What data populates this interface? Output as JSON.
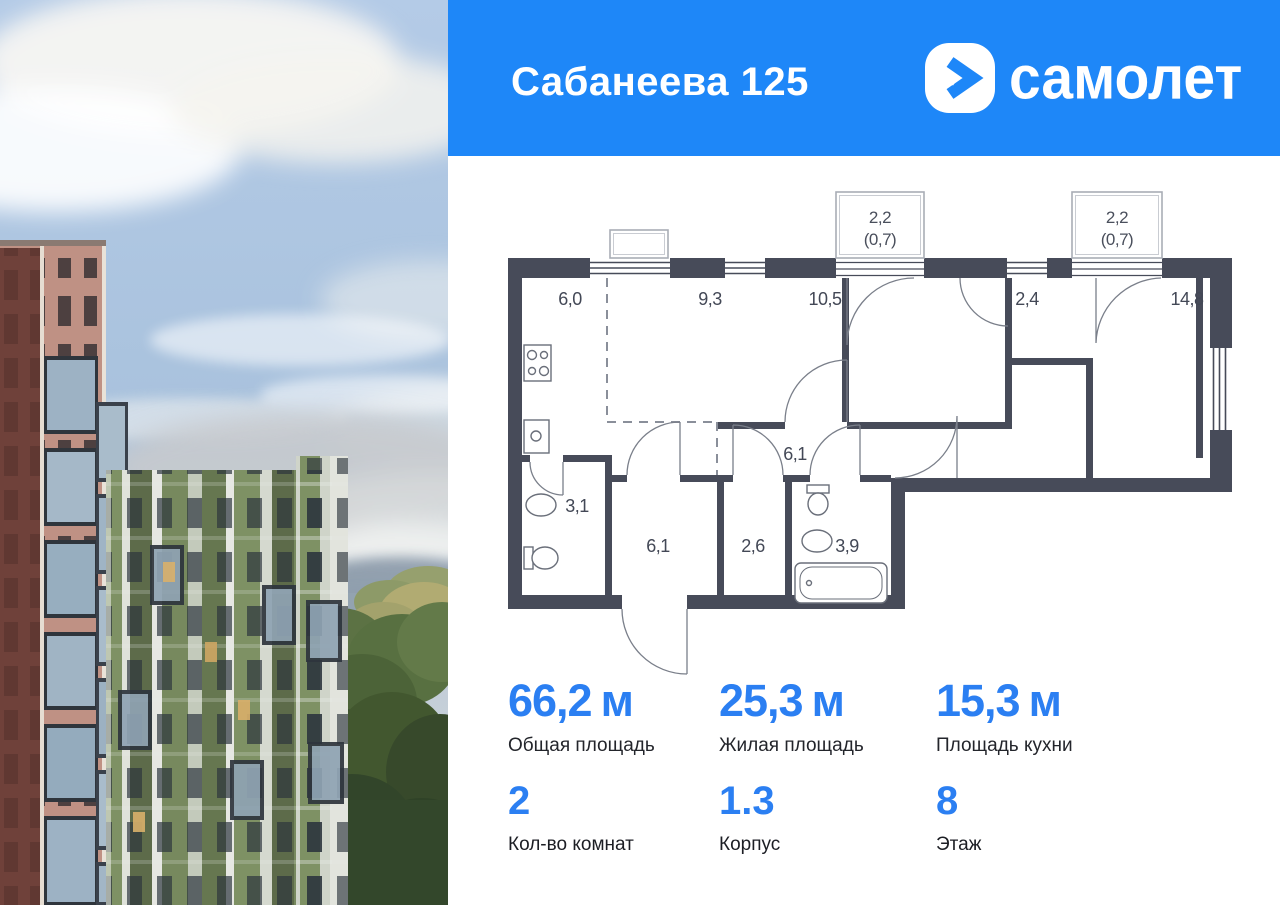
{
  "header": {
    "title": "Сабанеева 125",
    "brand": "самолет"
  },
  "plan": {
    "rooms": [
      {
        "name": "kitchen-zone",
        "area": "6,0"
      },
      {
        "name": "room-a",
        "area": "9,3"
      },
      {
        "name": "room-b",
        "area": "10,5"
      },
      {
        "name": "hall-small",
        "area": "2,4"
      },
      {
        "name": "living-room",
        "area": "14,8"
      },
      {
        "name": "corridor",
        "area": "6,1"
      },
      {
        "name": "bathroom-small",
        "area": "3,1"
      },
      {
        "name": "hallway",
        "area": "6,1"
      },
      {
        "name": "storage",
        "area": "2,6"
      },
      {
        "name": "bathroom-big",
        "area": "3,9"
      }
    ],
    "balconies": [
      {
        "area": "2,2",
        "reduced": "(0,7)"
      },
      {
        "area": "2,2",
        "reduced": "(0,7)"
      }
    ]
  },
  "stats": {
    "primary": [
      {
        "value": "66,2",
        "unit": "м",
        "label": "Общая площадь"
      },
      {
        "value": "25,3",
        "unit": "м",
        "label": "Жилая площадь"
      },
      {
        "value": "15,3",
        "unit": "м",
        "label": "Площадь кухни"
      }
    ],
    "secondary": [
      {
        "value": "2",
        "label": "Кол-во комнат"
      },
      {
        "value": "1.3",
        "label": "Корпус"
      },
      {
        "value": "8",
        "label": "Этаж"
      }
    ]
  },
  "colors": {
    "accent": "#1e87f8",
    "value_blue": "#2b7ff2",
    "wall": "#474b59"
  }
}
